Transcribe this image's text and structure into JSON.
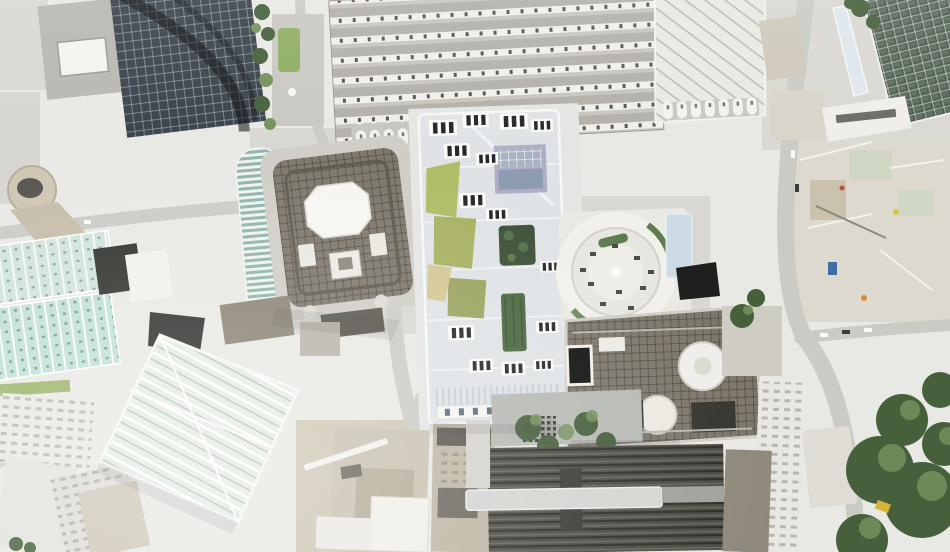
{
  "scene": {
    "type": "aerial-photograph",
    "view": "Top-down aerial photograph of a dense city district in bright daylight",
    "description": "Overhead nadir photo of a city centre: ribbed train-shed roofs across the top, a large pale office complex with white rooftop plant units and green roof gardens in the centre, a circular rooftop plaza with planters to its right, a square tower roof with a white octagonal core at centre-left, a dark glass high-rise at top-left, mint-green glass slabs along the left edge, a diagonal-lattice glass roof at lower-left, stone blocks and large street-tree canopies at right, a construction zone at mid-right and dark railway platform roofs along the bottom"
  },
  "palette": {
    "base": "#e8e8e4",
    "paving": "#d8d7d1",
    "road": "#cbcbc6",
    "roof_white": "#f4f3ef",
    "roof_pale": "#dfe3e6",
    "glass_dark": "#39424a",
    "station_band": "#b2b0a8",
    "station_skylight": "#f0efe9",
    "green_glass": "#4a5a4c",
    "mint_glass": "#cfe3da",
    "mint_glass_bright": "#bfe0d6",
    "teal_glass": "#8fb2a9",
    "brown_roof": "#7d766b",
    "octagon_core": "#f6f5f1",
    "stone": "#c9c2b2",
    "grass_green": "#aebd66",
    "olive_green": "#9aa45f",
    "sand": "#d2c794",
    "tree_dark": "#46603c",
    "tree_light": "#74915c",
    "hedge_green": "#5e7c50",
    "rail_dark": "#4c4b44",
    "rail_rib": "#2c2c27",
    "canopy_blue": "#cddbe4",
    "panel_blue": "#a9b2c2",
    "panel_purple": "#b0aec6",
    "construction_tan": "#ddd9cf",
    "accent_blue": "#3f6ea6",
    "accent_yellow": "#d6b13c",
    "car_dark": "#3c3c3a",
    "car_white": "#fafaf8"
  },
  "features": [
    {
      "id": "train-shed-roof",
      "label": "Ribbed train station roof"
    },
    {
      "id": "glass-truss-roof",
      "label": "Glazed truss roof"
    },
    {
      "id": "dark-glass-tower",
      "label": "Dark glass high-rise tower"
    },
    {
      "id": "helipad-block",
      "label": "Grey block with white rooftop pad"
    },
    {
      "id": "octagon-tower-roof",
      "label": "Square tower roof with white octagonal core"
    },
    {
      "id": "teal-striped-building",
      "label": "Teal striped curved building"
    },
    {
      "id": "central-office-complex",
      "label": "Large pale office complex with roof gardens"
    },
    {
      "id": "roof-garden",
      "label": "Green roof garden"
    },
    {
      "id": "circular-roof-plaza",
      "label": "Circular rooftop plaza with planters"
    },
    {
      "id": "brown-grid-building",
      "label": "Brown gridded rooftop with white drums"
    },
    {
      "id": "mint-glass-slabs",
      "label": "Mint-green glass roofs"
    },
    {
      "id": "diagonal-lattice-building",
      "label": "Pale green diagonal lattice roof"
    },
    {
      "id": "construction-zone",
      "label": "Construction site"
    },
    {
      "id": "railway-roofs",
      "label": "Dark railway platform roofs"
    },
    {
      "id": "street-trees",
      "label": "Street tree canopies"
    },
    {
      "id": "stone-blocks",
      "label": "Stone office blocks"
    },
    {
      "id": "streets",
      "label": "City streets with vehicles"
    },
    {
      "id": "round-tower",
      "label": "Round tan tower"
    }
  ]
}
